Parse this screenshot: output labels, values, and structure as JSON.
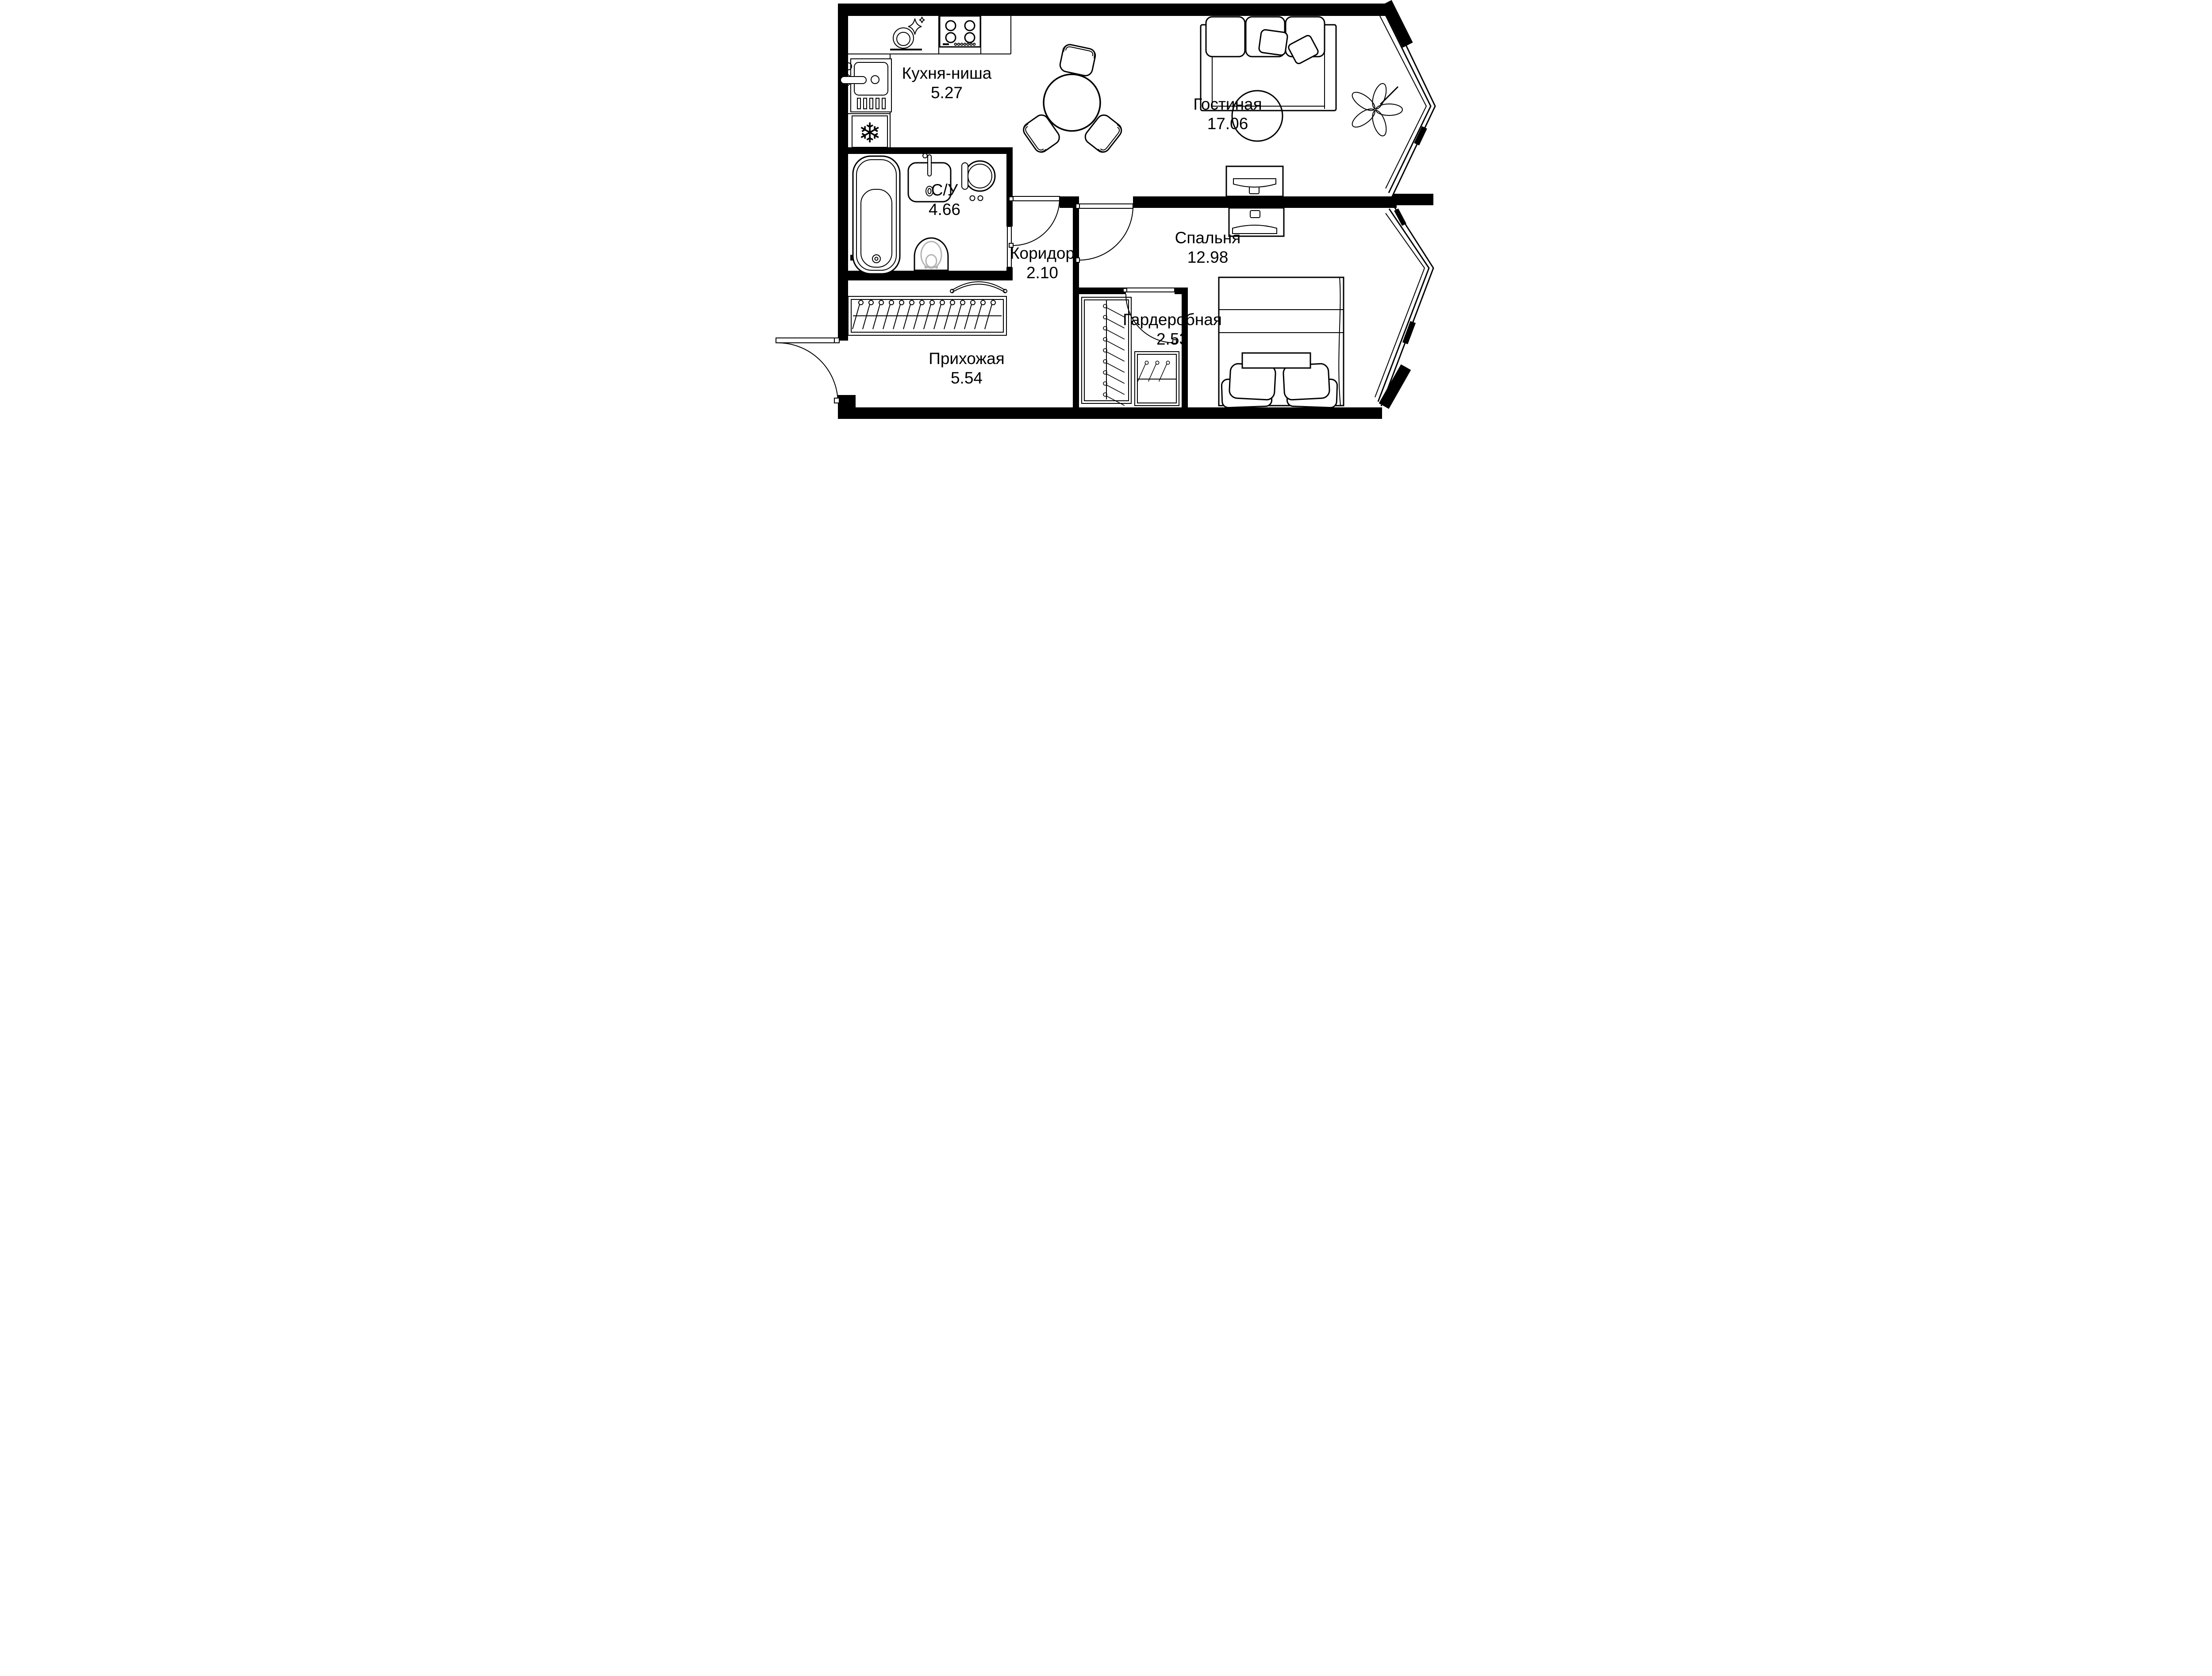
{
  "plan": {
    "type": "apartment-floor-plan",
    "language": "ru",
    "room_count": 7
  },
  "colors": {
    "background": "#ffffff",
    "walls": "#000000",
    "lines": "#000000",
    "toilet_seat_accent": "#b3b3b3"
  },
  "rooms": {
    "kitchen": {
      "name": "Кухня-ниша",
      "area": "5.27"
    },
    "living": {
      "name": "Гостиная",
      "area": "17.06"
    },
    "bathroom": {
      "name": "С/У",
      "area": "4.66"
    },
    "corridor": {
      "name": "Коридор",
      "area": "2.10"
    },
    "bedroom": {
      "name": "Спальня",
      "area": "12.98"
    },
    "wardrobe": {
      "name": "Гардеробная",
      "area": "2.53"
    },
    "hallway": {
      "name": "Прихожая",
      "area": "5.54"
    }
  },
  "fixtures": {
    "kitchen": [
      "dishwasher-plate-sparkle-icon",
      "stove-burners-icon",
      "kitchen-sink-icon",
      "fridge-snowflake-icon"
    ],
    "bathroom": [
      "bathtub-icon",
      "shelf-icon",
      "washbasin-icon",
      "washing-machine-icon",
      "toilet-icon"
    ],
    "living_room": [
      "dining-table-icon",
      "chair-icon",
      "sofa-icon",
      "throw-pillow-icon",
      "round-rug-icon",
      "plant-icon",
      "tv-console-icon"
    ],
    "bedroom": [
      "double-bed-icon",
      "pillow-icon",
      "dresser-tv-icon"
    ],
    "hallway": [
      "entry-door-arc-icon",
      "coat-rack-icon",
      "closet-hangers-icon"
    ],
    "wardrobe_room": [
      "hanger-rail-icon"
    ],
    "windows": [
      "bay-window-living",
      "bay-window-bedroom"
    ],
    "doors": [
      "entry-door",
      "living-corridor-door",
      "bedroom-door",
      "bathroom-door",
      "wardrobe-door"
    ]
  },
  "snowflake_glyph": "❄"
}
